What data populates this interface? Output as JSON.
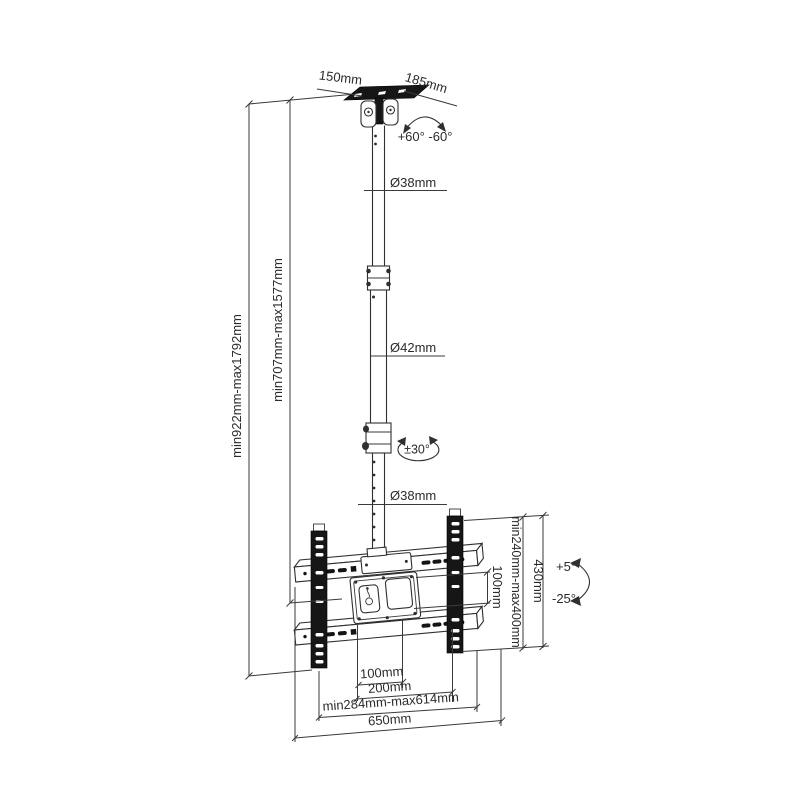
{
  "diagram": {
    "title": "TV ceiling mount dimensional drawing",
    "dimensions": {
      "ceiling_plate_width": "150mm",
      "ceiling_plate_depth": "185mm",
      "swivel_range": "+60° -60°",
      "upper_pole_diameter": "Ø38mm",
      "middle_pole_diameter": "Ø42mm",
      "pole_swivel": "±30°",
      "lower_pole_diameter": "Ø38mm",
      "overall_drop_range": "min922mm-max1792mm",
      "pole_drop_range": "min707mm-max1577mm",
      "vesa_vertical": "100mm",
      "bracket_height_range": "min240mm-max400mm",
      "bracket_height": "430mm",
      "tilt_up": "+5°",
      "tilt_down": "-25°",
      "vesa_horizontal": "100mm",
      "vesa_horizontal_max": "200mm",
      "tv_width_range": "min284mm-max614mm",
      "total_width": "650mm"
    },
    "colors": {
      "line": "#2f2f2f",
      "fill_dark": "#161616",
      "background": "#ffffff"
    }
  }
}
